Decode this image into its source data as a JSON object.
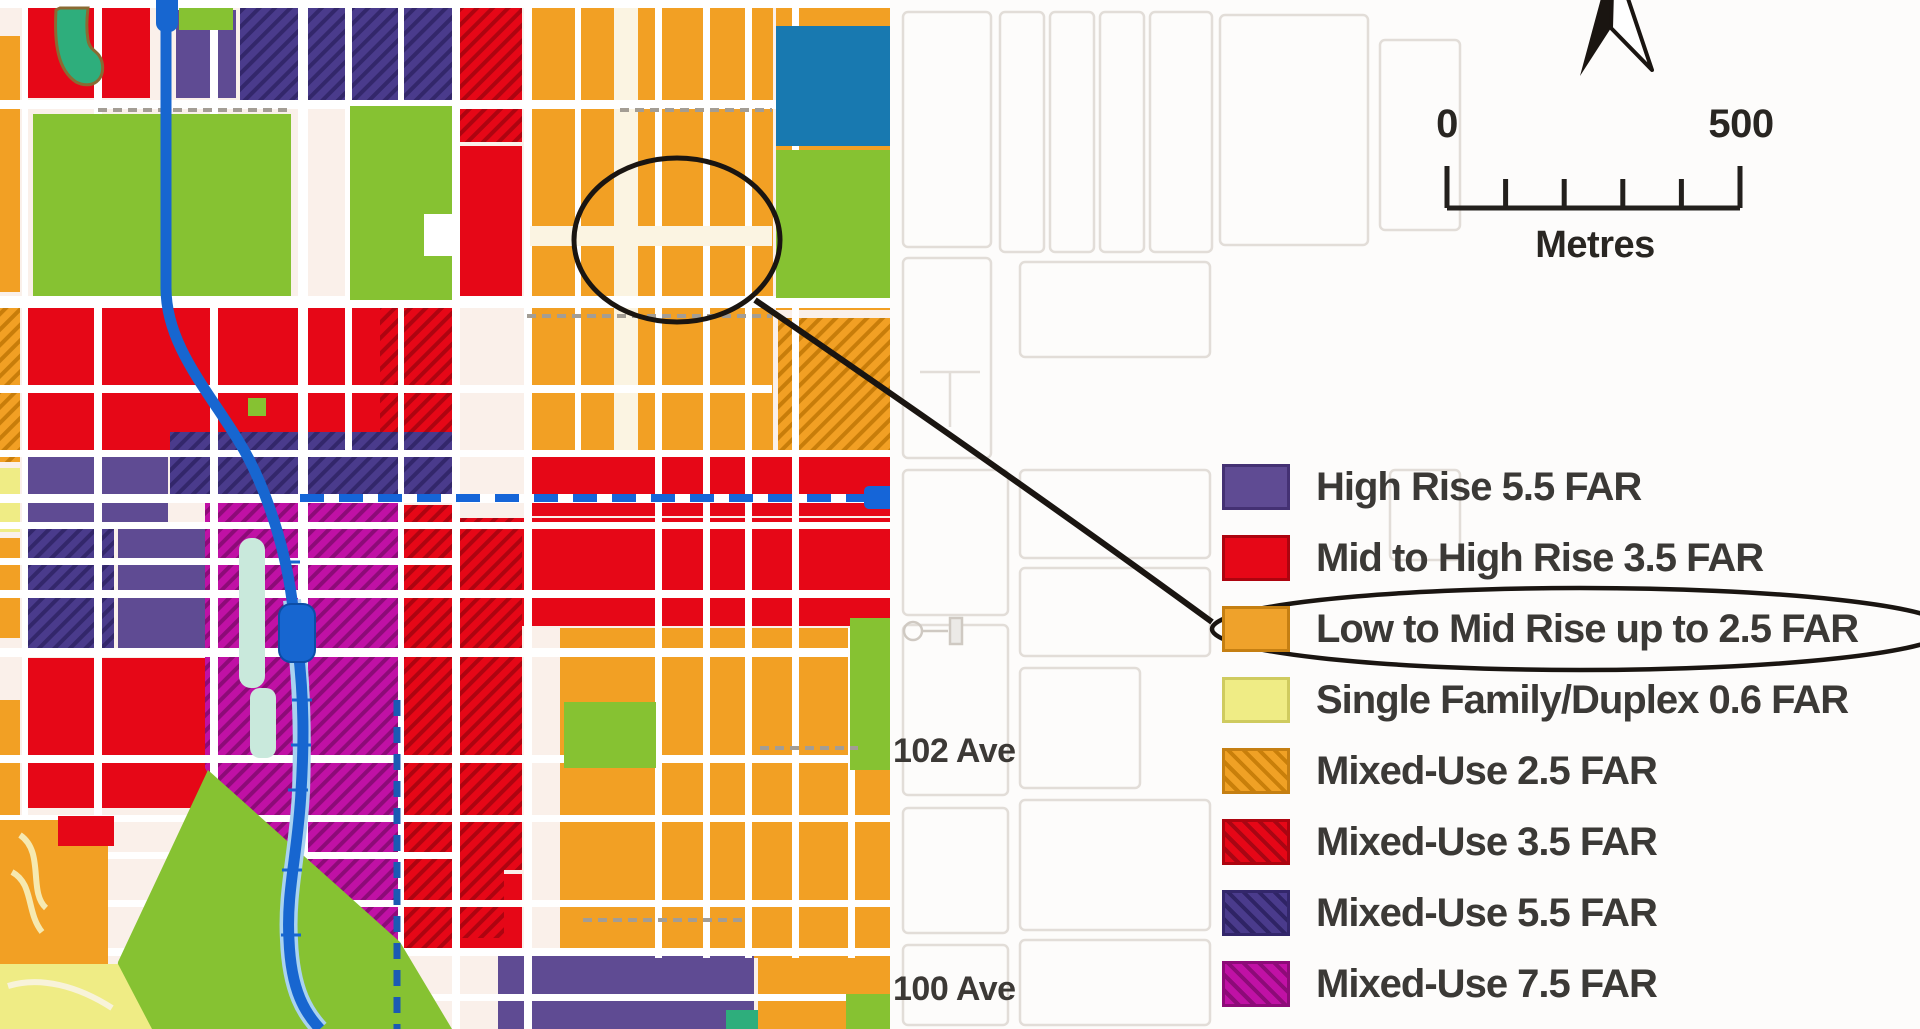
{
  "map": {
    "street_labels": [
      {
        "text": "102 Ave"
      },
      {
        "text": "100 Ave"
      }
    ],
    "annotations": {
      "highlight_circle": "circled low-to-mid-rise blocks on map",
      "callout_line": "connector from map circle to circled legend entry"
    }
  },
  "scale_bar": {
    "start": "0",
    "end": "500",
    "unit": "Metres"
  },
  "icons": {
    "north_arrow": "north-compass-arrow",
    "extension_arrow": "double-chevron-right-arrow"
  },
  "legend": {
    "items": [
      {
        "label": "High Rise 5.5 FAR",
        "color": "#5f4b93",
        "border": "#443173",
        "hatched": false,
        "circled": false
      },
      {
        "label": "Mid to High Rise 3.5 FAR",
        "color": "#e60717",
        "border": "#ad040f",
        "hatched": false,
        "circled": false
      },
      {
        "label": "Low to Mid Rise up to 2.5 FAR",
        "color": "#efa22b",
        "border": "#c57f12",
        "hatched": false,
        "circled": true
      },
      {
        "label": "Single Family/Duplex 0.6 FAR",
        "color": "#efec85",
        "border": "#cfcb5f",
        "hatched": false,
        "circled": false
      },
      {
        "label": "Mixed-Use 2.5 FAR",
        "color": "#f0a125",
        "hatch_color": "#c97f0a",
        "border": "#c57f12",
        "hatched": true,
        "circled": false
      },
      {
        "label": "Mixed-Use 3.5 FAR",
        "color": "#e60717",
        "hatch_color": "#a80613",
        "border": "#ad040f",
        "hatched": true,
        "circled": false
      },
      {
        "label": "Mixed-Use 5.5 FAR",
        "color": "#4a3b8c",
        "hatch_color": "#2f2465",
        "border": "#33276b",
        "hatched": true,
        "circled": false
      },
      {
        "label": "Mixed-Use 7.5 FAR",
        "color": "#c011a5",
        "hatch_color": "#8d0b78",
        "border": "#8d0b78",
        "hatched": true,
        "circled": false
      }
    ]
  },
  "palette": {
    "orange": "#f2a024",
    "orangeDark": "#c87d0a",
    "red": "#e60717",
    "redDark": "#ae0410",
    "purple": "#5f4b93",
    "purpleDark": "#463677",
    "indigo": "#4a3b8c",
    "indigoDark": "#33276b",
    "magenta": "#c011a5",
    "magentaDark": "#8d0b78",
    "lime": "#86c232",
    "emerald": "#2eae7c",
    "teal": "#1879b0",
    "paleYellow": "#efec85",
    "pond": "#c9e9dc",
    "lrtBlue": "#1766d0",
    "lrtCasing": "#a9d2f0",
    "dashBlue": "#1565d8",
    "dashBlueDark": "#1b5ab4",
    "ink": "#1a1511",
    "grayBoundary": "#a39d94",
    "fadedStroke": "#e2ddd8",
    "mapBg": "#faf0ea"
  }
}
